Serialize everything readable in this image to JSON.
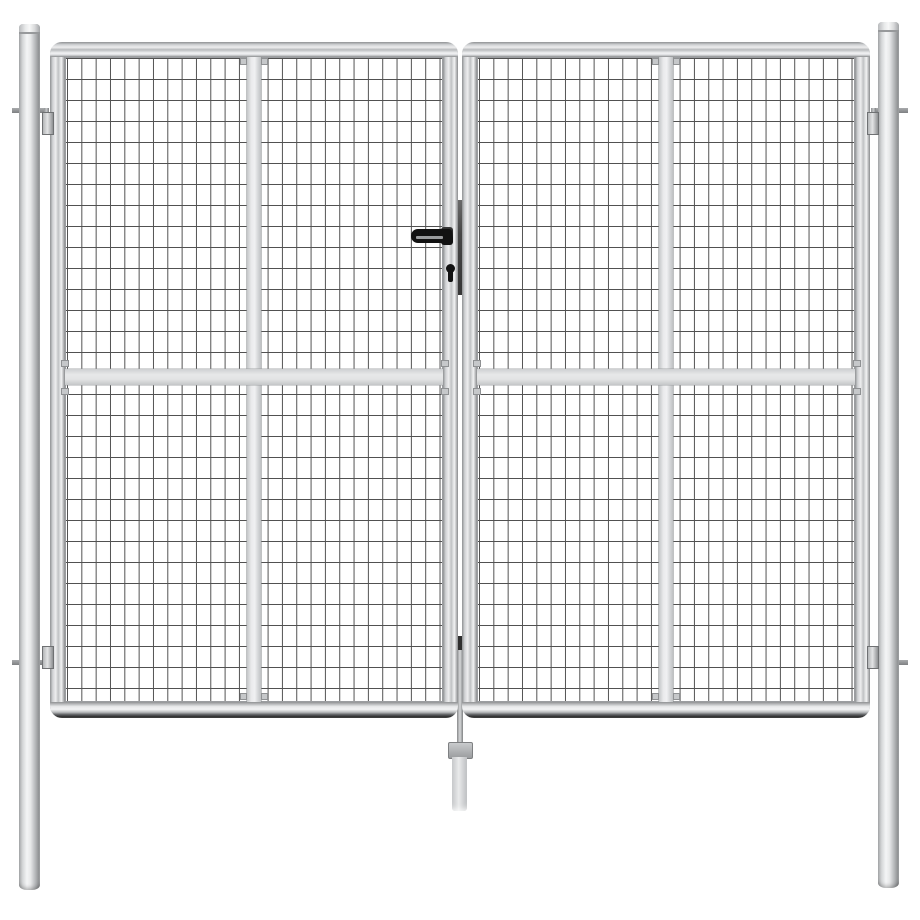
{
  "scene": {
    "subject": "Galvanised steel double garden gate with wire mesh infill, silver, on white background",
    "view": "front product photo",
    "background": "#ffffff"
  },
  "colors": {
    "background": "#ffffff",
    "mesh-line": "#515151",
    "steel-light": "#f4f5f6",
    "steel-mid": "#c9cbcd",
    "steel-dark": "#8f9193",
    "steel-edge": "#6f7173",
    "brace-fill": "#e2e3e4",
    "handle-black": "#121212",
    "lock-plate": "#474747",
    "shadow-dark": "#2d2d2d"
  },
  "components": {
    "left_post": "round mounting post (left)",
    "right_post": "round mounting post (right)",
    "left_leaf": "left gate leaf, tubular frame with welded wire mesh",
    "right_leaf": "right gate leaf, tubular frame with welded wire mesh",
    "vertical_brace": "vertical flat stiffener bar centred in each leaf",
    "horizontal_brace": "horizontal flat stiffener bar across both leaves",
    "hinges": "four hook hinges, two per post",
    "handle": "black lever handle on left leaf",
    "keyhole": "cylinder keyhole below handle",
    "lock_plate": "dark lock plate between the two leaves",
    "drop_rod": "centre drop rod with ground block and sleeve"
  },
  "mesh": {
    "pattern": "rectangular welded wire grid",
    "columns_per_leaf": 26,
    "rows_per_leaf": 30
  }
}
